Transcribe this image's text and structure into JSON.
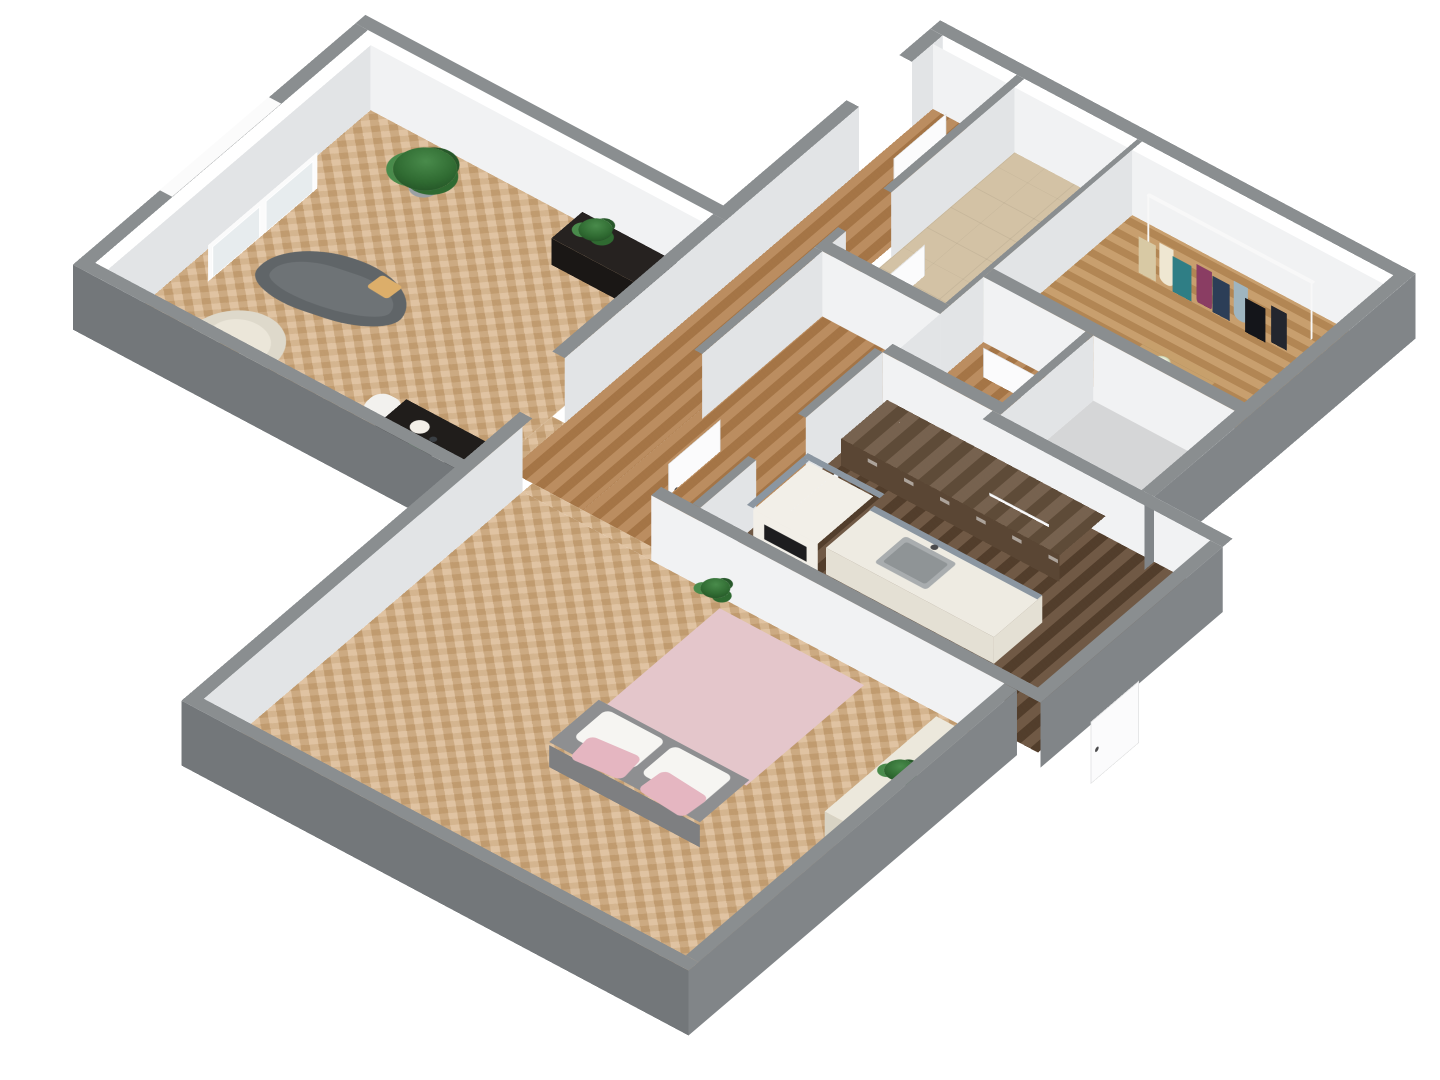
{
  "diagram": {
    "type": "3d-floor-plan",
    "view": "isometric-overhead",
    "background": "#ffffff",
    "text_labels": []
  },
  "palette": {
    "page-bg": "#ffffff",
    "wall-top": "#8a8e90",
    "wall-inner-s": "#f1f2f3",
    "wall-inner-e": "#e2e4e6",
    "wall-outer-s": "#73777a",
    "wall-outer-e": "#818588",
    "window-lintel": "#fbfbfb",
    "glass": "#e7ecee",
    "door": "#fbfbfc",
    "door-frame": "#d9dadb",
    "handle": "#4a4a4c",
    "floor-living": "#d6b083",
    "floor-corridor": "#b3804e",
    "floor-closet": "#c2945e",
    "floor-kitchen": "#644b35",
    "floor-bath": "#d3c2a5",
    "floor-gray": "#d5d6d7",
    "sofa": "#606568",
    "sofa-seat": "#6e7376",
    "armchair": "#ded9cb",
    "armchair-seat": "#ebe6d9",
    "pillow-tan": "#dcae6a",
    "pillow-white": "#f6f5f2",
    "pillow-pink": "#e5b6c1",
    "console": "#262220",
    "console-side": "#1a1715",
    "table": "#201d1b",
    "chair-white": "#f2f1ee",
    "plate": "#f3efe8",
    "bed-pink": "#e4c6cb",
    "bed-gray": "#8e8f91",
    "bed-side": "#7e7f81",
    "bench": "#ece8dc",
    "bench-side": "#d8d3c4",
    "counter-wood": "#6b5540",
    "cabinet-front": "#5a4634",
    "island-top": "#eeebe2",
    "island-side": "#e4e0d4",
    "sink": "#a9adaf",
    "sink-basin": "#8f9496",
    "backsplash": "#8b96a1",
    "stove": "#f2efe8",
    "oven": "#1d1d1f",
    "plant-dark": "#2f6a31",
    "plant-light": "#498b4b",
    "pot": "#9aa0a4",
    "dresser-top": "#c7a06c",
    "dresser-front": "#3a3029",
    "rail": "#f8f8f8",
    "flowers": "#f3efdc",
    "cloth-1": "#d8c9a4",
    "cloth-2": "#efe7d2",
    "cloth-3": "#2f7e85",
    "cloth-4": "#8a3d63",
    "cloth-5": "#2c3e57",
    "cloth-6": "#9fb5c0",
    "cloth-7": "#14151a",
    "cloth-8": "#23262e"
  },
  "rooms": [
    {
      "name": "living-room",
      "floor": "light-herringbone-wood",
      "furniture": [
        "curved-gray-sofa",
        "tan-pillow",
        "cream-armchair",
        "potted-plant",
        "black-tv-console",
        "console-plant",
        "black-dining-table",
        "white-shell-chair",
        "place-settings",
        "window"
      ]
    },
    {
      "name": "corridor",
      "floor": "medium-wood-planks",
      "furniture": [
        "entrance-door"
      ]
    },
    {
      "name": "bathroom",
      "floor": "beige-tile",
      "furniture": [
        "bathroom-door"
      ]
    },
    {
      "name": "walk-in-closet",
      "floor": "wood-planks",
      "furniture": [
        "clothes-rack",
        "hanging-clothes",
        "wood-dresser",
        "flower-vase"
      ]
    },
    {
      "name": "storage-room",
      "floor": "gray",
      "furniture": [
        "storage-door",
        "roomlet-door"
      ]
    },
    {
      "name": "kitchen",
      "floor": "dark-wood-planks",
      "furniture": [
        "back-counter",
        "island-with-sink",
        "stove",
        "kitchen-doors"
      ]
    },
    {
      "name": "bedroom",
      "floor": "light-herringbone-wood",
      "furniture": [
        "double-bed-pink",
        "white-pillows",
        "pink-pillows",
        "floor-plant",
        "cream-bench",
        "bench-plant",
        "bedroom-door"
      ]
    }
  ]
}
